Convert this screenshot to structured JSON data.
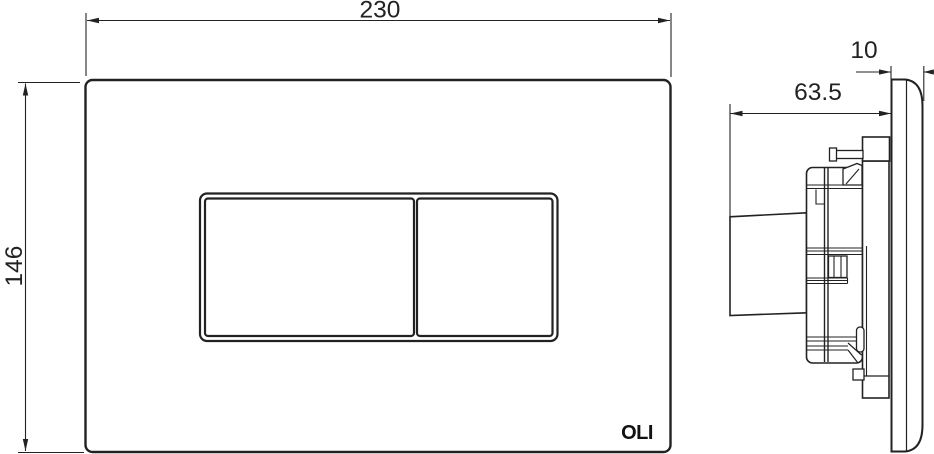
{
  "front_view": {
    "width_label": "230",
    "height_label": "146",
    "logo": "OLI"
  },
  "side_view": {
    "depth_label": "63.5",
    "thickness_label": "10"
  },
  "colors": {
    "line": "#222222",
    "background": "#ffffff"
  }
}
